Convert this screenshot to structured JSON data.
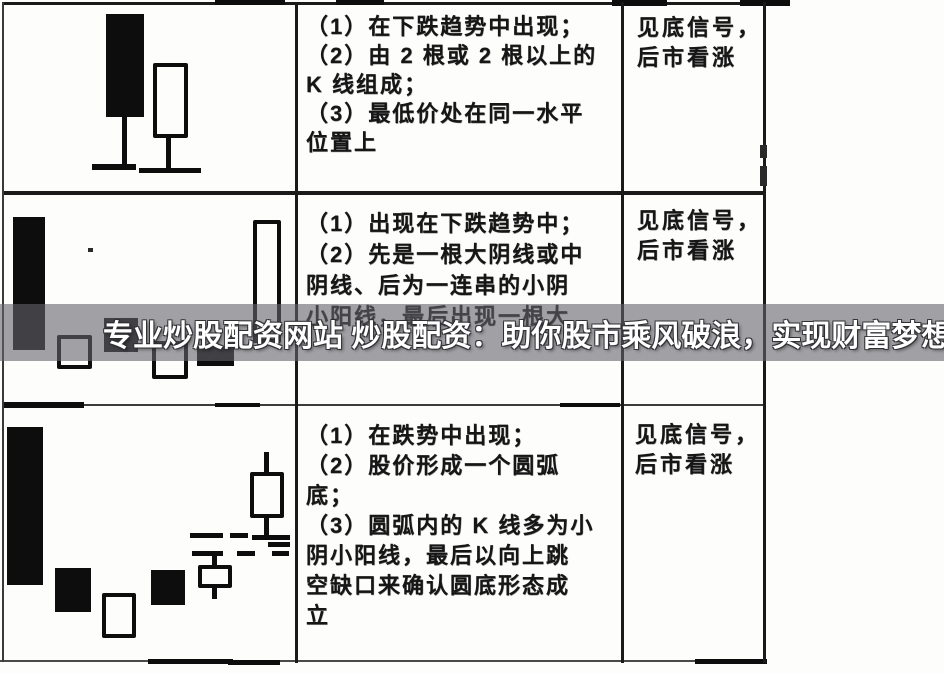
{
  "banner": {
    "text": "专业炒股配资网站 炒股配资：助你股市乘风破浪，实现财富梦想",
    "text_color": "#ffffff",
    "band_color": "rgba(100,100,106,0.6)"
  },
  "ink_color": "#0d0d0d",
  "table": {
    "rows": [
      {
        "conditions_lines": [
          "（1）在下跌趋势中出现；",
          "（2）由 2 根或 2 根以上的",
          "K 线组成；",
          "（3）最低价处在同一水平",
          "位置上"
        ],
        "signal_lines": [
          "见底信号，",
          "后市看涨"
        ]
      },
      {
        "conditions_lines": [
          "（1）出现在下跌趋势中；",
          "（2）先是一根大阴线或中",
          "阴线、后为一连串的小阴",
          "小阳线，最后出现一根大"
        ],
        "signal_lines": [
          "见底信号，",
          "后市看涨"
        ]
      },
      {
        "conditions_lines": [
          "（1）在跌势中出现；",
          "（2）股价形成一个圆弧",
          "底；",
          "（3）圆弧内的 K 线多为小",
          "阴小阳线，最后以向上跳",
          "空缺口来确认圆底形态成",
          "立"
        ],
        "signal_lines": [
          "见底信号，",
          "后市看涨"
        ]
      }
    ]
  },
  "figures": [
    {
      "elements": [
        {
          "t": "kb",
          "x": 106,
          "y": 14,
          "w": 38,
          "h": 103
        },
        {
          "t": "wick",
          "x": 122,
          "y": 115,
          "w": 5,
          "h": 53
        },
        {
          "t": "dash",
          "x": 92,
          "y": 164,
          "w": 44,
          "h": 6
        },
        {
          "t": "kw",
          "x": 153,
          "y": 63,
          "w": 35,
          "h": 75
        },
        {
          "t": "wick",
          "x": 166,
          "y": 136,
          "w": 5,
          "h": 33
        },
        {
          "t": "dash",
          "x": 139,
          "y": 168,
          "w": 62,
          "h": 5
        }
      ]
    },
    {
      "elements": [
        {
          "t": "kb",
          "x": 13,
          "y": 217,
          "w": 32,
          "h": 133
        },
        {
          "t": "kw",
          "x": 57,
          "y": 335,
          "w": 35,
          "h": 34
        },
        {
          "t": "kb",
          "x": 104,
          "y": 318,
          "w": 34,
          "h": 34
        },
        {
          "t": "kw",
          "x": 152,
          "y": 341,
          "w": 36,
          "h": 38
        },
        {
          "t": "kb",
          "x": 197,
          "y": 346,
          "w": 37,
          "h": 20
        },
        {
          "t": "kw",
          "x": 253,
          "y": 220,
          "w": 28,
          "h": 123
        }
      ]
    },
    {
      "elements": [
        {
          "t": "kb",
          "x": 7,
          "y": 427,
          "w": 36,
          "h": 158
        },
        {
          "t": "kb",
          "x": 55,
          "y": 568,
          "w": 36,
          "h": 44
        },
        {
          "t": "kw",
          "x": 102,
          "y": 593,
          "w": 34,
          "h": 45
        },
        {
          "t": "kb",
          "x": 151,
          "y": 570,
          "w": 34,
          "h": 35
        },
        {
          "t": "wick",
          "x": 212,
          "y": 553,
          "w": 5,
          "h": 14
        },
        {
          "t": "kw",
          "x": 198,
          "y": 565,
          "w": 34,
          "h": 23
        },
        {
          "t": "wick",
          "x": 212,
          "y": 588,
          "w": 5,
          "h": 11
        },
        {
          "t": "wick",
          "x": 264,
          "y": 452,
          "w": 5,
          "h": 21
        },
        {
          "t": "kw",
          "x": 250,
          "y": 472,
          "w": 34,
          "h": 46
        },
        {
          "t": "wick",
          "x": 264,
          "y": 518,
          "w": 5,
          "h": 17
        },
        {
          "t": "dash",
          "x": 190,
          "y": 533,
          "w": 33,
          "h": 5
        },
        {
          "t": "dash",
          "x": 230,
          "y": 533,
          "w": 18,
          "h": 5
        },
        {
          "t": "dash",
          "x": 252,
          "y": 535,
          "w": 38,
          "h": 5
        },
        {
          "t": "dash",
          "x": 268,
          "y": 542,
          "w": 22,
          "h": 5
        },
        {
          "t": "dash",
          "x": 192,
          "y": 551,
          "w": 31,
          "h": 5
        },
        {
          "t": "dash",
          "x": 237,
          "y": 551,
          "w": 18,
          "h": 5
        },
        {
          "t": "dash",
          "x": 272,
          "y": 551,
          "w": 17,
          "h": 5
        }
      ]
    }
  ]
}
